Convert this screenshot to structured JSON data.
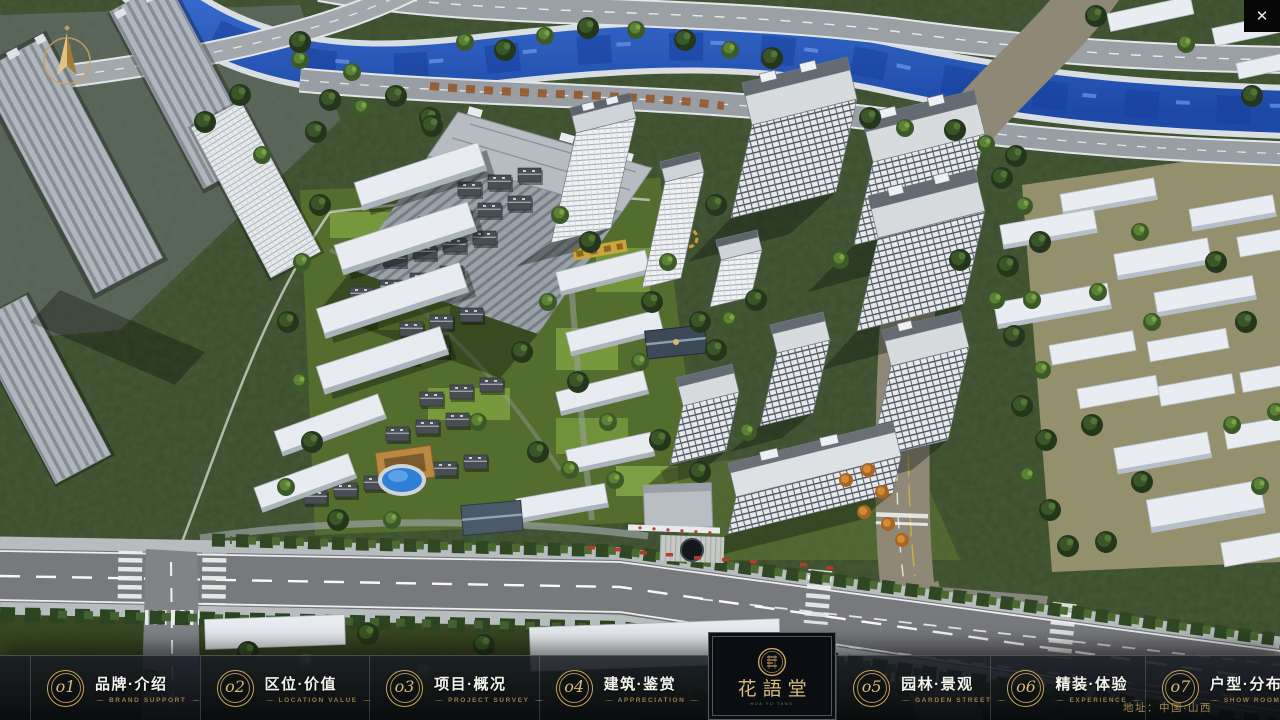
{
  "window": {
    "close_glyph": "✕"
  },
  "brand": {
    "name": "花語堂",
    "subtitle": "HUA YU TANG",
    "accent_gold": "#C9A35F",
    "bar_dark": "#0B0E13",
    "text_white": "#F4F2EC"
  },
  "nav": {
    "items": [
      {
        "num": "o1",
        "label": "品牌·介绍",
        "caption": "BRAND SUPPORT"
      },
      {
        "num": "o2",
        "label": "区位·价值",
        "caption": "LOCATION VALUE"
      },
      {
        "num": "o3",
        "label": "项目·概况",
        "caption": "PROJECT SURVEY"
      },
      {
        "num": "o4",
        "label": "建筑·鉴赏",
        "caption": "APPRECIATION"
      },
      {
        "num": "o5",
        "label": "园林·景观",
        "caption": "GARDEN STREET"
      },
      {
        "num": "o6",
        "label": "精装·体验",
        "caption": "EXPERIENCE"
      },
      {
        "num": "o7",
        "label": "户型·分布",
        "caption": "SHOW ROOM"
      },
      {
        "num": "o8",
        "label": "一房·一景",
        "caption": "COMMUNITY"
      }
    ]
  },
  "footer": {
    "address": "地址：中国·山西"
  }
}
